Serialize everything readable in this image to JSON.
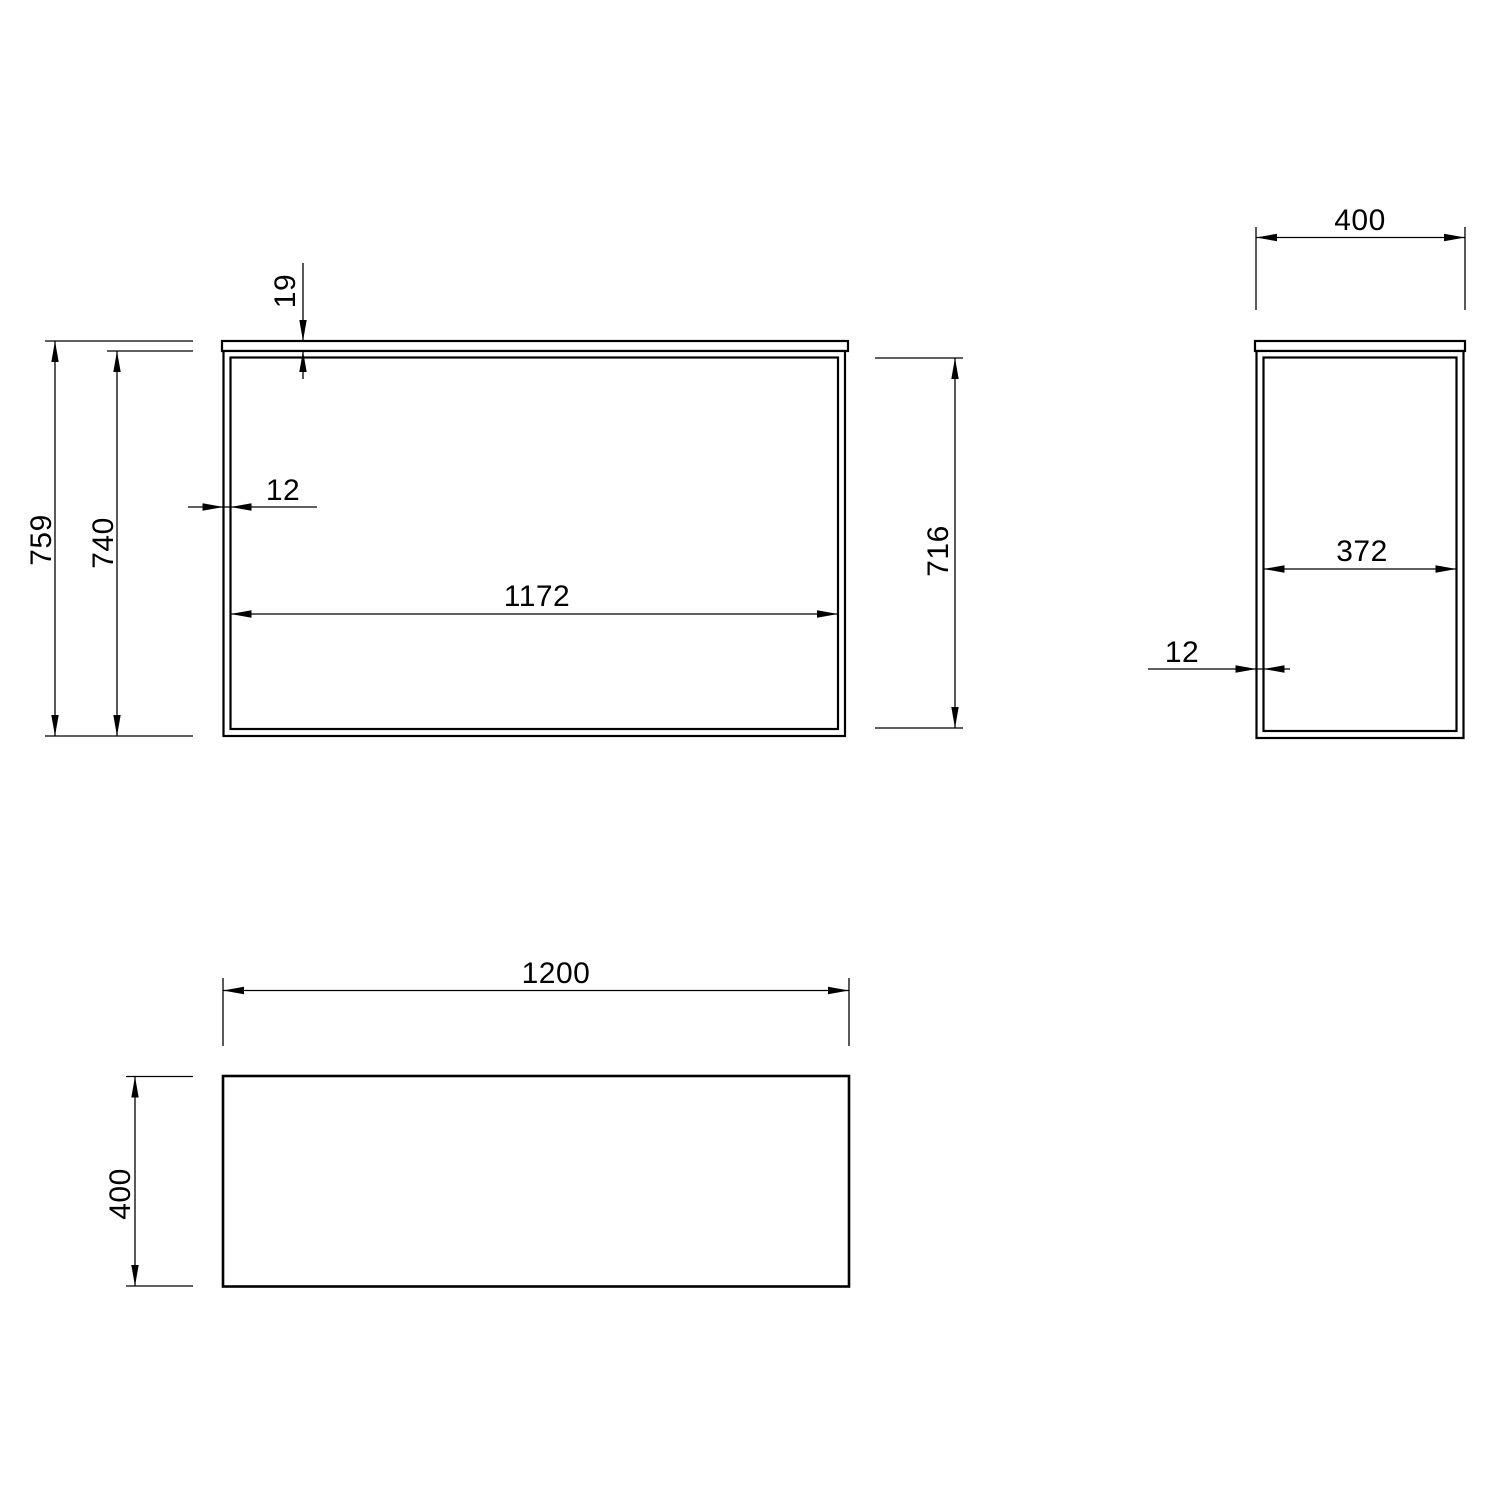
{
  "drawing": {
    "background_color": "#ffffff",
    "line_color": "#000000",
    "views": {
      "front": {
        "dims": {
          "top_thickness": "19",
          "overall_height": "759",
          "frame_height": "740",
          "wall_thickness": "12",
          "inner_width": "1172",
          "inner_height": "716"
        }
      },
      "side": {
        "dims": {
          "overall_depth": "400",
          "inner_depth": "372",
          "wall_thickness": "12"
        }
      },
      "top": {
        "dims": {
          "overall_width": "1200",
          "overall_depth": "400"
        }
      }
    }
  }
}
